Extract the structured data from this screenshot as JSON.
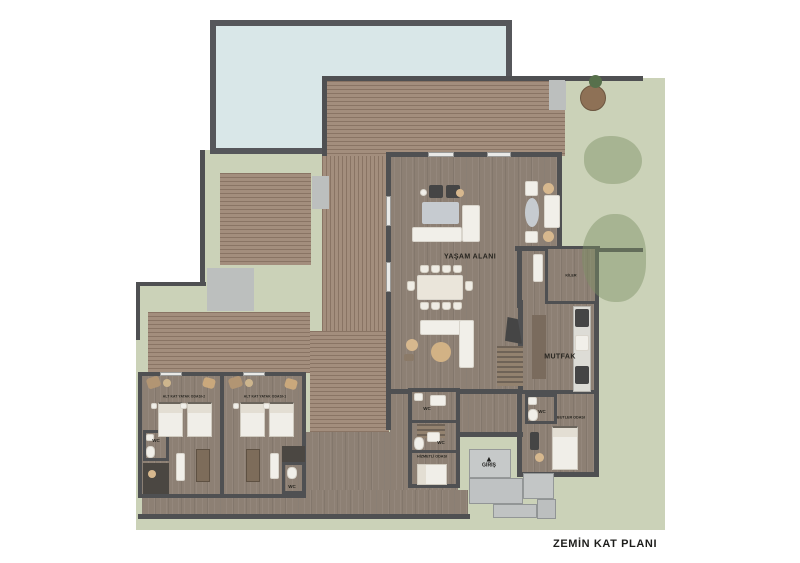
{
  "plan": {
    "title": "ZEMİN KAT PLANI",
    "labels": {
      "living": "YAŞAM ALANI",
      "pantry": "KİLER",
      "kitchen": "MUTFAK",
      "butler": "BUTLER ODASI",
      "service": "HİZMETLİ ODASI",
      "bedroom2": "ALT KAT YATAK ODASI-2",
      "bedroom1": "ALT KAT YATAK ODASI-1",
      "entrance": "GİRİŞ",
      "entrance_arrow": "▲",
      "wc": "WC"
    },
    "colors": {
      "background": "#ffffff",
      "grass": "#cbd2b8",
      "pool_water": "#d9e7e8",
      "wall": "#4f5052",
      "deck_wood": "#a38e7d",
      "interior_floor": "#8d8074",
      "stone": "#c3c6c6",
      "accent_beige": "#d7b88e"
    }
  }
}
